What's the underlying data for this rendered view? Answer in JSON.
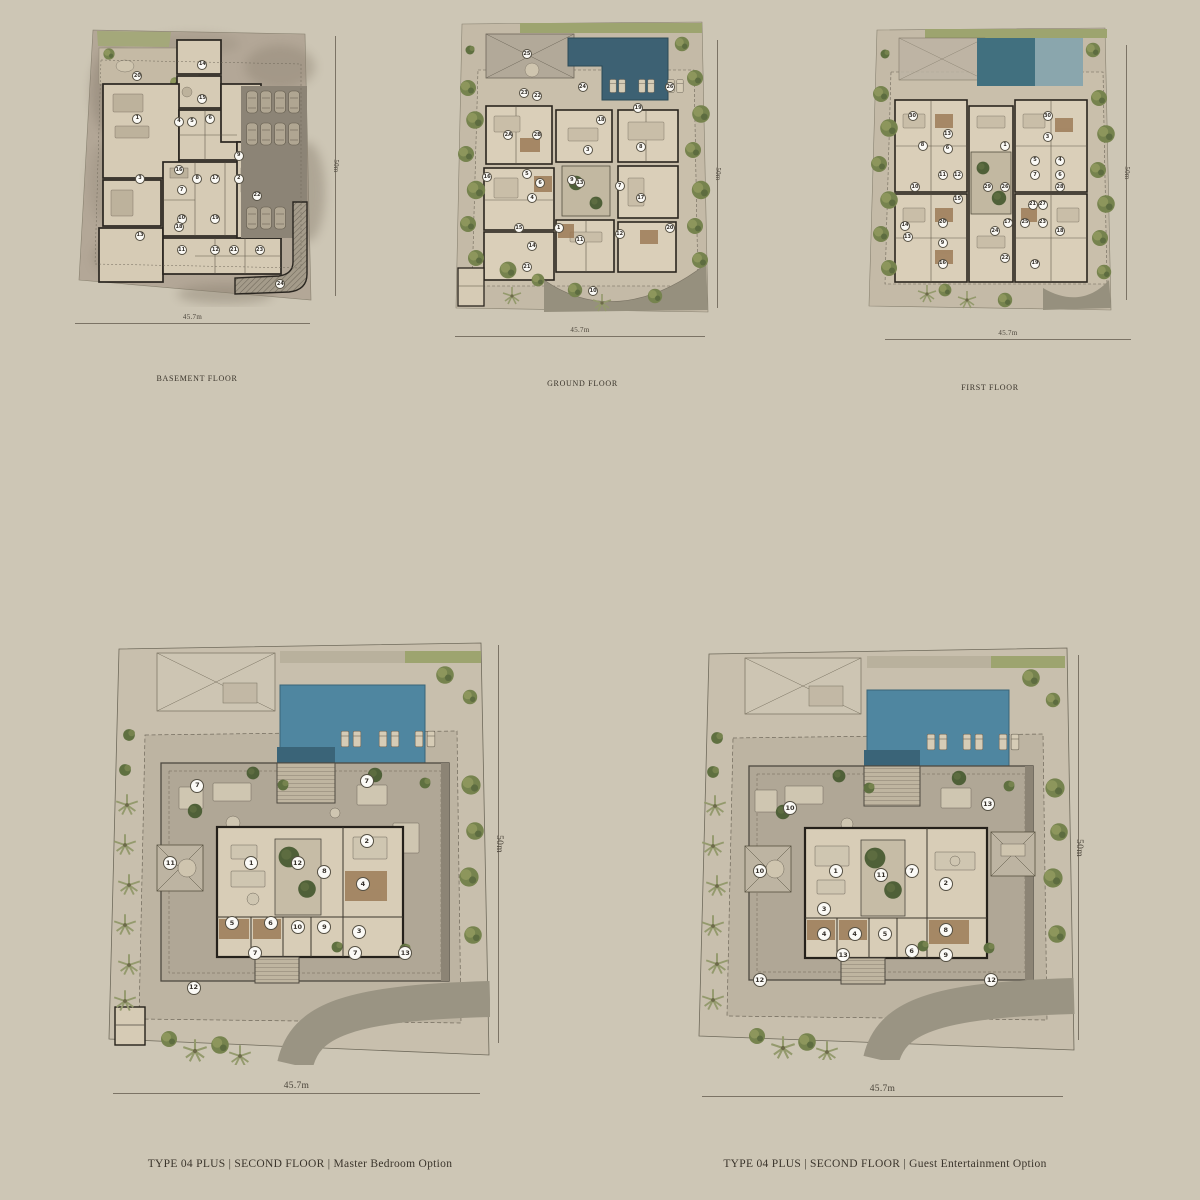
{
  "page": {
    "background_color": "#cdc6b5",
    "text_color": "#3a342b",
    "colors": {
      "pool_dark": "#3d6173",
      "pool_light": "#4f86a0",
      "vegetation": "#76834e",
      "terrace": "#b0a796",
      "walls": "#2a251e",
      "driveway": "#96907e"
    }
  },
  "plans": [
    {
      "id": "basement",
      "caption": "BASEMENT FLOOR",
      "width_dim": "45.7m",
      "height_dim": "50m",
      "markers": [
        {
          "n": "14",
          "x": 49,
          "y": 15
        },
        {
          "n": "20",
          "x": 24,
          "y": 19
        },
        {
          "n": "15",
          "x": 49,
          "y": 27
        },
        {
          "n": "1",
          "x": 24,
          "y": 34
        },
        {
          "n": "4",
          "x": 40,
          "y": 35
        },
        {
          "n": "5",
          "x": 45,
          "y": 35
        },
        {
          "n": "6",
          "x": 52,
          "y": 34
        },
        {
          "n": "9",
          "x": 63,
          "y": 47
        },
        {
          "n": "3",
          "x": 25,
          "y": 55
        },
        {
          "n": "16",
          "x": 40,
          "y": 52
        },
        {
          "n": "8",
          "x": 47,
          "y": 55
        },
        {
          "n": "7",
          "x": 41,
          "y": 59
        },
        {
          "n": "17",
          "x": 54,
          "y": 55
        },
        {
          "n": "2",
          "x": 63,
          "y": 55
        },
        {
          "n": "22",
          "x": 70,
          "y": 61
        },
        {
          "n": "10",
          "x": 41,
          "y": 69
        },
        {
          "n": "19",
          "x": 54,
          "y": 69
        },
        {
          "n": "13",
          "x": 25,
          "y": 75
        },
        {
          "n": "18",
          "x": 40,
          "y": 72
        },
        {
          "n": "11",
          "x": 41,
          "y": 80
        },
        {
          "n": "12",
          "x": 54,
          "y": 80
        },
        {
          "n": "21",
          "x": 61,
          "y": 80
        },
        {
          "n": "23",
          "x": 71,
          "y": 80
        },
        {
          "n": "24",
          "x": 79,
          "y": 92
        }
      ]
    },
    {
      "id": "ground",
      "caption": "GROUND FLOOR",
      "width_dim": "45.7m",
      "height_dim": "50m",
      "markers": [
        {
          "n": "25",
          "x": 29,
          "y": 12
        },
        {
          "n": "24",
          "x": 50,
          "y": 23
        },
        {
          "n": "26",
          "x": 83,
          "y": 23
        },
        {
          "n": "23",
          "x": 28,
          "y": 25
        },
        {
          "n": "22",
          "x": 33,
          "y": 26
        },
        {
          "n": "19",
          "x": 71,
          "y": 30
        },
        {
          "n": "18",
          "x": 57,
          "y": 34
        },
        {
          "n": "2A",
          "x": 22,
          "y": 39
        },
        {
          "n": "2B",
          "x": 33,
          "y": 39
        },
        {
          "n": "3",
          "x": 52,
          "y": 44
        },
        {
          "n": "8",
          "x": 72,
          "y": 43
        },
        {
          "n": "16",
          "x": 14,
          "y": 53
        },
        {
          "n": "5",
          "x": 29,
          "y": 52
        },
        {
          "n": "6",
          "x": 34,
          "y": 55
        },
        {
          "n": "9",
          "x": 46,
          "y": 54
        },
        {
          "n": "13",
          "x": 49,
          "y": 55
        },
        {
          "n": "7",
          "x": 64,
          "y": 56
        },
        {
          "n": "17",
          "x": 72,
          "y": 60
        },
        {
          "n": "4",
          "x": 31,
          "y": 60
        },
        {
          "n": "15",
          "x": 26,
          "y": 70
        },
        {
          "n": "14",
          "x": 31,
          "y": 76
        },
        {
          "n": "1",
          "x": 41,
          "y": 70
        },
        {
          "n": "11",
          "x": 49,
          "y": 74
        },
        {
          "n": "12",
          "x": 64,
          "y": 72
        },
        {
          "n": "20",
          "x": 83,
          "y": 70
        },
        {
          "n": "21",
          "x": 29,
          "y": 83
        },
        {
          "n": "10",
          "x": 54,
          "y": 91
        }
      ]
    },
    {
      "id": "first",
      "caption": "FIRST FLOOR",
      "width_dim": "45.7m",
      "height_dim": "50m",
      "markers": [
        {
          "n": "30",
          "x": 19,
          "y": 32
        },
        {
          "n": "30",
          "x": 73,
          "y": 32
        },
        {
          "n": "8",
          "x": 23,
          "y": 42
        },
        {
          "n": "13",
          "x": 33,
          "y": 38
        },
        {
          "n": "6",
          "x": 33,
          "y": 43
        },
        {
          "n": "1",
          "x": 56,
          "y": 42
        },
        {
          "n": "3",
          "x": 73,
          "y": 39
        },
        {
          "n": "5",
          "x": 68,
          "y": 47
        },
        {
          "n": "4",
          "x": 78,
          "y": 47
        },
        {
          "n": "7",
          "x": 68,
          "y": 52
        },
        {
          "n": "6",
          "x": 78,
          "y": 52
        },
        {
          "n": "28",
          "x": 78,
          "y": 56
        },
        {
          "n": "10",
          "x": 20,
          "y": 56
        },
        {
          "n": "11",
          "x": 31,
          "y": 52
        },
        {
          "n": "12",
          "x": 37,
          "y": 52
        },
        {
          "n": "15",
          "x": 37,
          "y": 60
        },
        {
          "n": "29",
          "x": 49,
          "y": 56
        },
        {
          "n": "26",
          "x": 56,
          "y": 56
        },
        {
          "n": "21",
          "x": 67,
          "y": 62
        },
        {
          "n": "27",
          "x": 71,
          "y": 62
        },
        {
          "n": "14",
          "x": 16,
          "y": 69
        },
        {
          "n": "13",
          "x": 17,
          "y": 73
        },
        {
          "n": "20",
          "x": 31,
          "y": 68
        },
        {
          "n": "9",
          "x": 31,
          "y": 75
        },
        {
          "n": "24",
          "x": 52,
          "y": 71
        },
        {
          "n": "17",
          "x": 57,
          "y": 68
        },
        {
          "n": "25",
          "x": 64,
          "y": 68
        },
        {
          "n": "23",
          "x": 71,
          "y": 68
        },
        {
          "n": "18",
          "x": 78,
          "y": 71
        },
        {
          "n": "16",
          "x": 31,
          "y": 82
        },
        {
          "n": "22",
          "x": 56,
          "y": 80
        },
        {
          "n": "19",
          "x": 68,
          "y": 82
        }
      ]
    },
    {
      "id": "master",
      "caption": "TYPE 04 PLUS | SECOND FLOOR | Master Bedroom Option",
      "width_dim": "45.7m",
      "height_dim": "50m",
      "markers": [
        {
          "n": "7",
          "x": 24,
          "y": 35
        },
        {
          "n": "7",
          "x": 68,
          "y": 34
        },
        {
          "n": "2",
          "x": 68,
          "y": 48
        },
        {
          "n": "11",
          "x": 17,
          "y": 53
        },
        {
          "n": "1",
          "x": 38,
          "y": 53
        },
        {
          "n": "12",
          "x": 50,
          "y": 53
        },
        {
          "n": "8",
          "x": 57,
          "y": 55
        },
        {
          "n": "4",
          "x": 67,
          "y": 58
        },
        {
          "n": "5",
          "x": 33,
          "y": 67
        },
        {
          "n": "6",
          "x": 43,
          "y": 67
        },
        {
          "n": "10",
          "x": 50,
          "y": 68
        },
        {
          "n": "9",
          "x": 57,
          "y": 68
        },
        {
          "n": "3",
          "x": 66,
          "y": 69
        },
        {
          "n": "7",
          "x": 39,
          "y": 74
        },
        {
          "n": "7",
          "x": 65,
          "y": 74
        },
        {
          "n": "13",
          "x": 78,
          "y": 74
        },
        {
          "n": "12",
          "x": 23,
          "y": 82
        }
      ]
    },
    {
      "id": "guest",
      "caption": "TYPE 04 PLUS | SECOND FLOOR | Guest Entertainment Option",
      "width_dim": "45.7m",
      "height_dim": "50m",
      "markers": [
        {
          "n": "10",
          "x": 25,
          "y": 40
        },
        {
          "n": "13",
          "x": 77,
          "y": 39
        },
        {
          "n": "10",
          "x": 17,
          "y": 55
        },
        {
          "n": "1",
          "x": 37,
          "y": 55
        },
        {
          "n": "11",
          "x": 49,
          "y": 56
        },
        {
          "n": "7",
          "x": 57,
          "y": 55
        },
        {
          "n": "2",
          "x": 66,
          "y": 58
        },
        {
          "n": "3",
          "x": 34,
          "y": 64
        },
        {
          "n": "4",
          "x": 34,
          "y": 70
        },
        {
          "n": "4",
          "x": 42,
          "y": 70
        },
        {
          "n": "5",
          "x": 50,
          "y": 70
        },
        {
          "n": "6",
          "x": 57,
          "y": 74
        },
        {
          "n": "8",
          "x": 66,
          "y": 69
        },
        {
          "n": "9",
          "x": 66,
          "y": 75
        },
        {
          "n": "13",
          "x": 39,
          "y": 75
        },
        {
          "n": "12",
          "x": 17,
          "y": 81
        },
        {
          "n": "12",
          "x": 78,
          "y": 81
        }
      ]
    }
  ]
}
